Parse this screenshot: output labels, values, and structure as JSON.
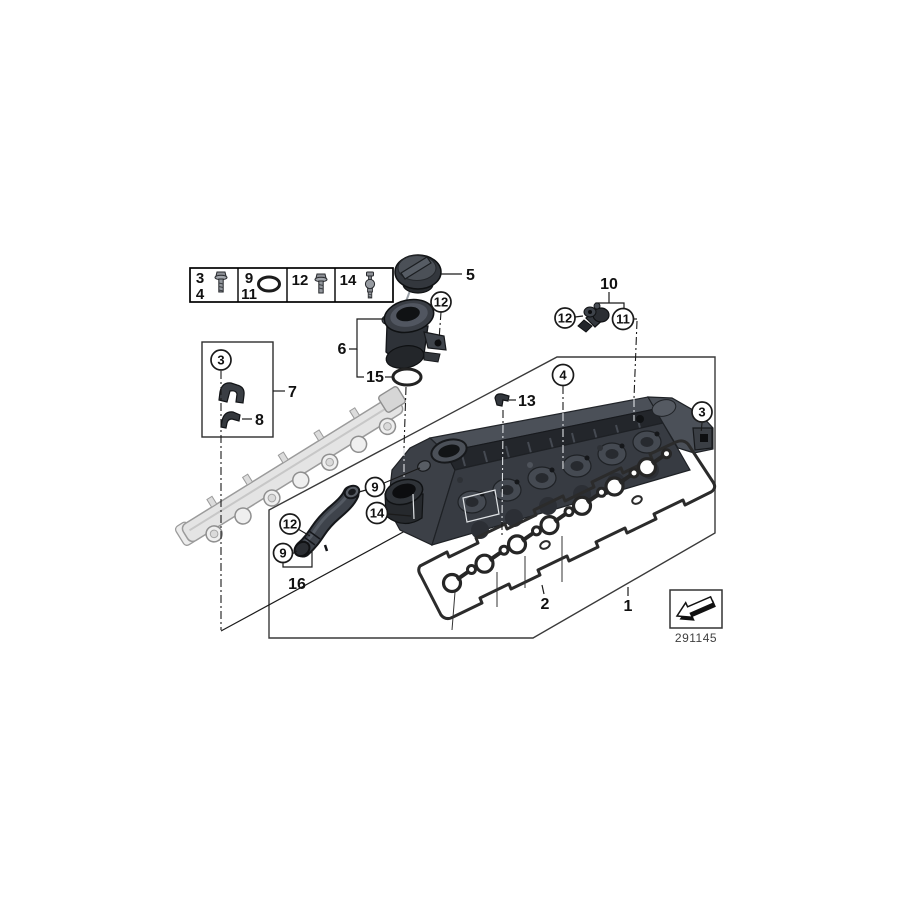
{
  "fastener_legend": {
    "cells": [
      {
        "top": "3",
        "bottom": "4",
        "icon": "hex-bolt-icon"
      },
      {
        "top": "9",
        "bottom": "11",
        "icon": "o-ring-icon"
      },
      {
        "top": "12",
        "bottom": "",
        "icon": "hex-bolt-icon"
      },
      {
        "top": "14",
        "bottom": "",
        "icon": "ball-stud-icon"
      }
    ]
  },
  "callouts": {
    "cover_assembly": "1",
    "gasket_set": "2",
    "filler_cap": "5",
    "filler_neck": "6",
    "bracket": "7",
    "clamp": "8",
    "sensor_group": "10",
    "cable_clip": "13",
    "o_ring": "15",
    "vent_hose": "16",
    "circled": {
      "neck_screw": "12",
      "bracket_screw": "3",
      "cover": "4",
      "cover_bolt": "3",
      "sensor_screw": "12",
      "camshaft_sensor": "11",
      "hose_seal_upper": "9",
      "ball_stud": "14",
      "hose_screw": "12",
      "hose_seal_lower": "9"
    }
  },
  "footer": {
    "diagram_number": "291145"
  }
}
